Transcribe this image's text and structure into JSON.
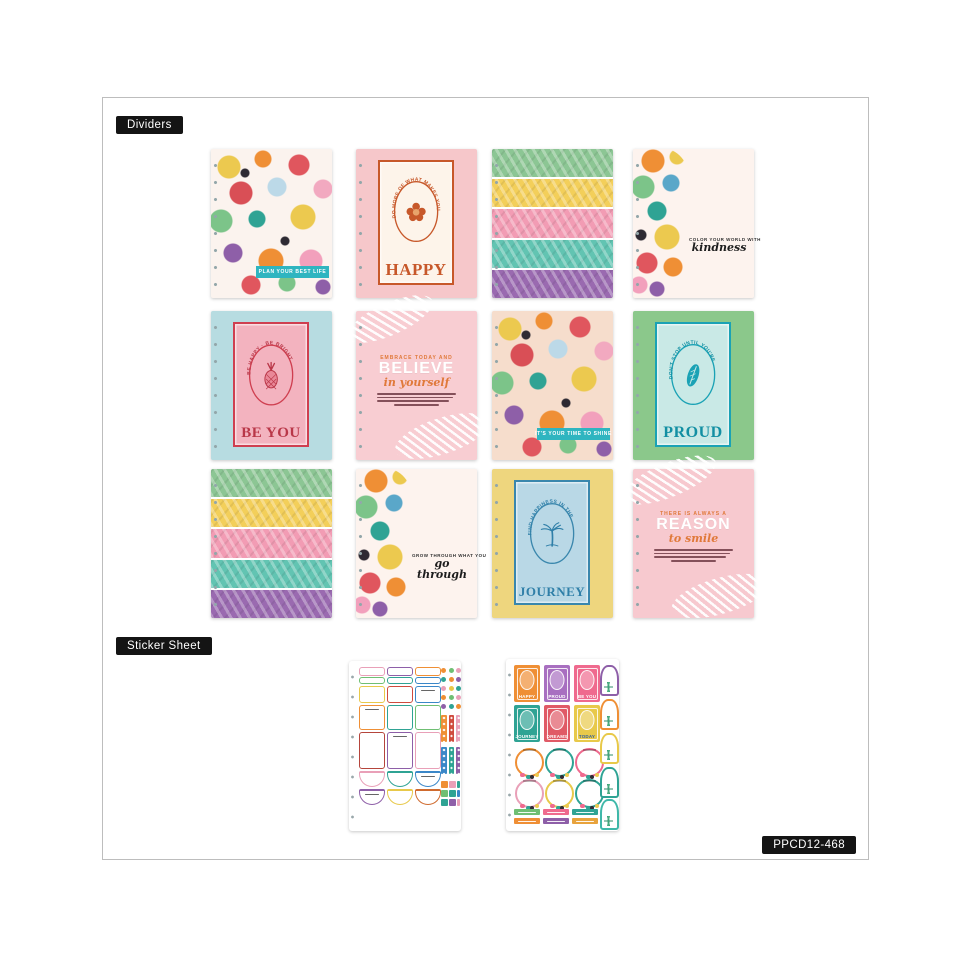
{
  "labels": {
    "dividers": "Dividers",
    "sticker_sheet": "Sticker Sheet",
    "product_code": "PPCD12-468",
    "badge_bg": "#141414",
    "badge_text": "#ffffff"
  },
  "dividers": [
    {
      "name": "tropical collage divider",
      "style": "floral-collage",
      "tab_color": "#2fb5c0",
      "banner_text": "PLAN YOUR BEST LIFE",
      "banner_color": "#2fb5c0"
    },
    {
      "name": "happy stamp divider",
      "style": "stamp",
      "bg": "#f6c7ca",
      "tab_color": "#f3bfc3",
      "accent": "#c7582a",
      "frame_bg": "#fdf4ea",
      "arc_text": "DO MORE OF WHAT MAKES YOU",
      "word": "HAPPY",
      "word_color": "#c7582a",
      "icon": "hibiscus-flower-icon"
    },
    {
      "name": "tropical stripes divider",
      "style": "stripes",
      "tab_color": "#ffffff",
      "stripes": [
        "#8cc694",
        "#f3cf5a",
        "#f29cb4",
        "#62c4b2",
        "#9a6ab0"
      ]
    },
    {
      "name": "kindness quote divider",
      "style": "quote-floral",
      "bg": "#fdf3ee",
      "tab_color": "#1c1c1c",
      "line": "COLOR YOUR WORLD WITH",
      "script": "kindness"
    },
    {
      "name": "be you stamp divider",
      "style": "stamp",
      "bg": "#b7dce1",
      "tab_color": "#b7dce1",
      "accent": "#cf3f50",
      "frame_bg": "#f3b3bf",
      "arc_text": "BE HAPPY · BE BRIGHT",
      "word": "BE YOU",
      "word_color": "#b93748",
      "icon": "pineapple-icon"
    },
    {
      "name": "believe quote divider",
      "style": "quote-palms",
      "bg": "#f8cdd2",
      "tab_color": "#e8873e",
      "accent": "#e0793a",
      "line": "EMBRACE TODAY AND",
      "word": "BELIEVE",
      "word_color": "#ffffff",
      "script": "in yourself"
    },
    {
      "name": "tropical collage divider 2",
      "style": "floral-collage",
      "tab_color": "#2c2c2c",
      "banner_text": "IT'S YOUR TIME TO SHINE",
      "banner_color": "#2fb5c0"
    },
    {
      "name": "proud stamp divider",
      "style": "stamp",
      "bg": "#8bc88b",
      "tab_color": "#8bc88b",
      "accent": "#1aa2b5",
      "frame_bg": "#c9e9e6",
      "arc_text": "DON'T STOP UNTIL YOU'RE",
      "word": "PROUD",
      "word_color": "#128fa3",
      "icon": "tropical-leaf-icon"
    },
    {
      "name": "tropical stripes divider 2",
      "style": "stripes",
      "tab_color": "#ffffff",
      "stripes": [
        "#8cc694",
        "#f3cf5a",
        "#f29cb4",
        "#62c4b2",
        "#9a6ab0"
      ]
    },
    {
      "name": "go through quote divider",
      "style": "quote-floral",
      "bg": "#fdf3ee",
      "tab_color": "#1c1c1c",
      "line": "GROW THROUGH WHAT YOU",
      "script": "go through"
    },
    {
      "name": "journey stamp divider",
      "style": "stamp",
      "bg": "#eed67e",
      "tab_color": "#eed67e",
      "accent": "#3a87ad",
      "frame_bg": "#b9d8e6",
      "arc_text": "FIND HAPPINESS IN THE",
      "word": "JOURNEY",
      "word_color": "#2f7fa8",
      "icon": "palm-tree-icon"
    },
    {
      "name": "reason to smile quote divider",
      "style": "quote-palms",
      "bg": "#f7c9cf",
      "tab_color": "#e8873e",
      "accent": "#e0793a",
      "line": "THERE IS ALWAYS A",
      "word": "REASON",
      "word_color": "#ffffff",
      "script": "to smile"
    }
  ],
  "stickers": {
    "sheet1": {
      "name": "functional boxes sticker sheet",
      "header_strips": [
        "#e9a0b8",
        "#8e5fa8",
        "#ef8f35"
      ],
      "thin_strips": [
        "#6fbf73",
        "#2fa394",
        "#3a87c8"
      ],
      "small_boxes": [
        "#e8c94a",
        "#cf4b3e",
        "#3a87c8"
      ],
      "medium_boxes": [
        "#ef8f35",
        "#2fa394",
        "#6fbf73"
      ],
      "tall_boxes": [
        "#b5453c",
        "#8e5fa8",
        "#e9a0b8"
      ],
      "half_circles_row1": [
        "#e9a0b8",
        "#2fa394",
        "#3a87c8"
      ],
      "half_circles_row2": [
        "#8e5fa8",
        "#e8c94a",
        "#cf6a2e"
      ],
      "dot_rows": [
        [
          "#ef8f35",
          "#6fbf73",
          "#e9a0b8"
        ],
        [
          "#2fa394",
          "#ef8f35",
          "#8e5fa8"
        ],
        [
          "#e9a0b8",
          "#e8c94a",
          "#2fa394"
        ],
        [
          "#ef8f35",
          "#6fbf73",
          "#e9a0b8"
        ],
        [
          "#8e5fa8",
          "#2fa394",
          "#ef8f35"
        ]
      ],
      "strip_group1": [
        "#ef8f35",
        "#cf4b3e",
        "#e9a0b8"
      ],
      "strip_group2": [
        "#3a87c8",
        "#2fa394",
        "#8e5fa8"
      ],
      "square_rows": [
        [
          "#ef8f35",
          "#e9a0b8",
          "#2fa394"
        ],
        [
          "#6fbf73",
          "#2fa394",
          "#3a87c8"
        ],
        [
          "#2fa394",
          "#8e5fa8",
          "#e9a0b8"
        ]
      ]
    },
    "sheet2": {
      "name": "stamps and wreaths sticker sheet",
      "stamps": [
        {
          "label": "HAPPY",
          "bg": "#ef8f35",
          "label_color": "#ffffff"
        },
        {
          "label": "PROUD",
          "bg": "#a86fc0",
          "label_color": "#ffffff"
        },
        {
          "label": "BE YOU",
          "bg": "#ef6a8e",
          "label_color": "#ffffff"
        },
        {
          "label": "JOURNEY",
          "bg": "#2fa394",
          "label_color": "#ffffff"
        },
        {
          "label": "DREAMS",
          "bg": "#e05a66",
          "label_color": "#ffffff"
        },
        {
          "label": "TODAY",
          "bg": "#e8c94a",
          "label_color": "#2f5f9e"
        }
      ],
      "wreath_rings": [
        "#ef8f35",
        "#2fa394",
        "#ef6a8e",
        "#e9a0b8",
        "#e8c94a",
        "#2fa394"
      ],
      "arches": [
        "#8e5fa8",
        "#ef8f35",
        "#e8c94a",
        "#2fa394",
        "#3fb8a9"
      ],
      "label_strips_row1": [
        "#6fbf73",
        "#ef6a8e",
        "#2fa394"
      ],
      "label_strips_row2": [
        "#ef8f35",
        "#8e5fa8",
        "#e8a33c"
      ]
    }
  }
}
